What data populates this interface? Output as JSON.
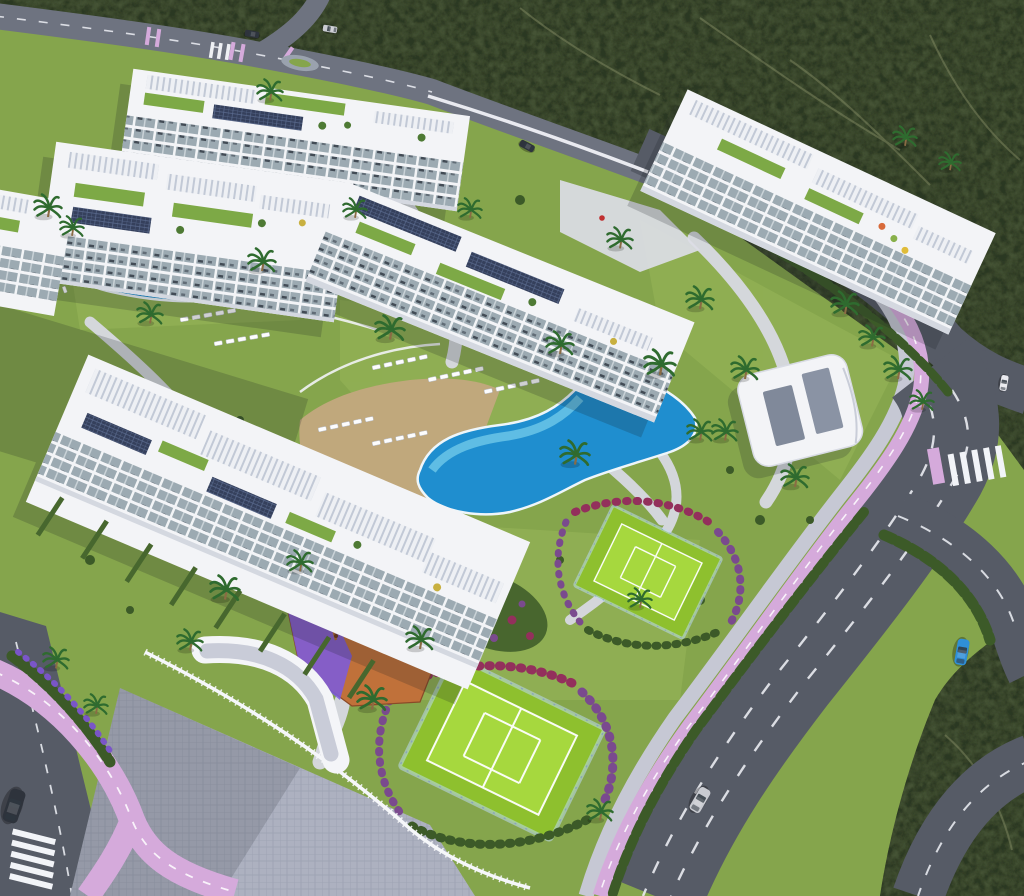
{
  "image": {
    "type": "3d-aerial-architectural-render",
    "subject": "Gated residential apartment development with landscaped amenities, seen from a high aerial angle",
    "no_visible_text": true
  },
  "scene": {
    "background": "dark mediterranean scrubland with faint trails at top and bottom-right corner",
    "buildings": [
      {
        "id": "block-a",
        "desc": "white 4-storey apartment block, top-left rear row, rooftop gardens and solar panels"
      },
      {
        "id": "block-b",
        "desc": "white apartment block, upper-left front row with stepped roof terraces"
      },
      {
        "id": "block-c",
        "desc": "white apartment block at left edge above the small pool"
      },
      {
        "id": "block-d",
        "desc": "long central apartment block with rooftop solar arrays"
      },
      {
        "id": "block-e",
        "desc": "long top-right apartment block with roof pergolas, terraces and parasols"
      },
      {
        "id": "block-f",
        "desc": "large foreground block with white slatted pergola roofs and private hedge gardens"
      },
      {
        "id": "clubhouse",
        "desc": "low rounded white community building with two grey solar strips on the roof"
      }
    ],
    "amenities": [
      {
        "id": "pool-main",
        "desc": "large free-form blue pool with tan sun deck and rows of white loungers"
      },
      {
        "id": "pool-left",
        "desc": "smaller curved pool with lounger rows on the lawn"
      },
      {
        "id": "tennis-court-upper",
        "desc": "bright green fenced court with white markings ringed by flowering shrubs"
      },
      {
        "id": "tennis-court-lower",
        "desc": "bright green fenced court with white markings ringed by flowering shrubs"
      },
      {
        "id": "playground",
        "desc": "orange rubber-surface playground with purple strip, swings, climbing frame and red slide"
      }
    ],
    "roads": [
      {
        "id": "top-road",
        "desc": "road along the top boundary with X intersection, pink cycle markings and small median"
      },
      {
        "id": "main-avenue",
        "desc": "wide grey avenue down the right side with dashed lanes, pink cycle lane and sidewalk"
      },
      {
        "id": "slip-road",
        "desc": "curved slip road looping around a scrub island at bottom right"
      },
      {
        "id": "crosswalk-right",
        "desc": "zebra crossing where the avenue meets the right edge"
      },
      {
        "id": "bottom-left-roads",
        "desc": "lavender cycle path forking beside a grey street with zebra crossing"
      },
      {
        "id": "entry-plaza",
        "desc": "paved entrance plaza with white ramp walls and picket fence"
      }
    ],
    "vehicles": [
      {
        "id": "car-silver",
        "location": "main avenue, lower middle"
      },
      {
        "id": "car-blue",
        "location": "curved slip road, right side"
      },
      {
        "id": "car-dark-suv",
        "location": "left edge street near zebra crossing"
      },
      {
        "id": "car-top-1",
        "location": "top intersection, west arm"
      },
      {
        "id": "car-top-2",
        "location": "top intersection, near median"
      },
      {
        "id": "car-parked",
        "location": "service road behind central block"
      },
      {
        "id": "car-right-small",
        "location": "right-edge road"
      }
    ],
    "vegetation": "scattered palm trees, clipped perimeter hedges, magenta and purple flowering borders"
  },
  "palette": {
    "scrub": "#455234",
    "scrub_dark": "#2c3823",
    "trail": "#8a9168",
    "lawn": "#85a54c",
    "lawn_light": "#a9c562",
    "lawn_shade": "#5d7a37",
    "court_green": "#8ec02e",
    "court_inner": "#a6d83e",
    "court_line": "#ffffff",
    "pool_deep": "#1f8ecf",
    "pool_light": "#6fc9e8",
    "pool_rim": "#eef6fa",
    "deck": "#c3a87e",
    "road": "#565b66",
    "road_light": "#6e7380",
    "sidewalk": "#c6c8d4",
    "bike_lane": "#d5aadb",
    "plaza": "#adb1c0",
    "building": "#f3f4f7",
    "building_shade": "#d4d8e0",
    "glass": "#9caab2",
    "solar": "#35405c",
    "hedge": "#3c5a28",
    "palm_green": "#2f6b2f",
    "trunk": "#8a6b44",
    "flower_red": "#93305c",
    "flower_purple": "#7a4a8e",
    "flower_lavender": "#7a55c8",
    "pg_orange": "#c0713a",
    "pg_purple": "#7a5ae0",
    "slide_red": "#d03426",
    "umbrella_yellow": "#e8c83a",
    "car_silver": "#c9cbd1",
    "car_blue": "#2f8fd8",
    "car_dark": "#2e333c",
    "car_white": "#e8e9ee",
    "wall_white": "#f2f3f6",
    "shadow": "#1a1f26"
  }
}
